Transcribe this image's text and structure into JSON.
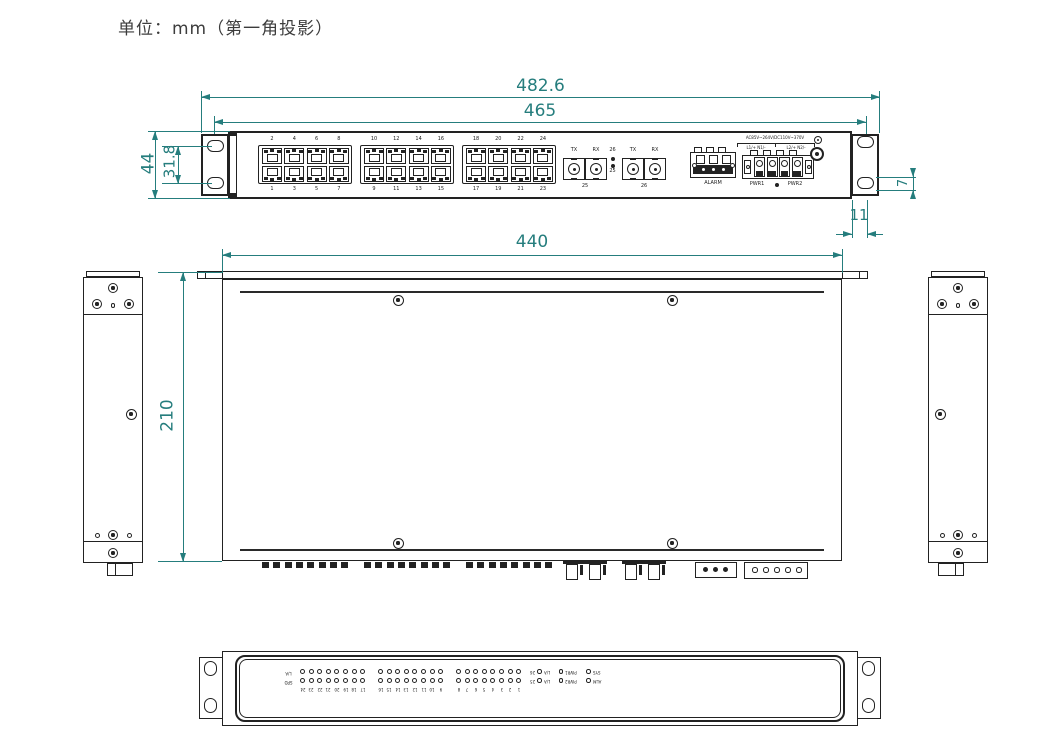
{
  "title": "单位：mm（第一角投影）",
  "colors": {
    "line": "#222222",
    "dimension": "#257d7d"
  },
  "dimensions": {
    "overall_width": "482.6",
    "mounting_width": "465",
    "panel_height": "44",
    "ear_hole_spacing": "31.8",
    "ear_hole_height": "7",
    "ear_depth": "11",
    "body_width": "440",
    "body_depth": "210"
  },
  "front_panel": {
    "port_numbers_top": [
      "2",
      "4",
      "6",
      "8",
      "10",
      "12",
      "14",
      "16",
      "18",
      "20",
      "22",
      "24"
    ],
    "port_numbers_bottom": [
      "1",
      "3",
      "5",
      "7",
      "9",
      "11",
      "13",
      "15",
      "17",
      "19",
      "21",
      "23"
    ],
    "fiber": {
      "tx_label": "TX",
      "rx_label": "RX",
      "port1": "25",
      "port2": "26",
      "led_top": "26",
      "led_bottom": "25"
    },
    "alarm_label": "ALARM",
    "power": {
      "rating": "AC85V~264V/DC110V~370V",
      "input1": "L1/+  N1/-",
      "input2": "L2/+  N2/-",
      "pwr1_label": "PWR1",
      "pwr2_label": "PWR2"
    }
  },
  "bottom_panel": {
    "row_label_top": "L/A",
    "row_label_bottom": "SPD",
    "group_numbers": [
      [
        "24",
        "23",
        "22",
        "21",
        "20",
        "19",
        "18",
        "17"
      ],
      [
        "16",
        "15",
        "14",
        "13",
        "12",
        "11",
        "10",
        "9"
      ],
      [
        "8",
        "7",
        "6",
        "5",
        "4",
        "3",
        "2",
        "1"
      ]
    ],
    "status_rows": [
      [
        "26",
        "L/A",
        "PWR1",
        "SYS"
      ],
      [
        "25",
        "L/A",
        "PWR2",
        "ALM"
      ]
    ]
  }
}
